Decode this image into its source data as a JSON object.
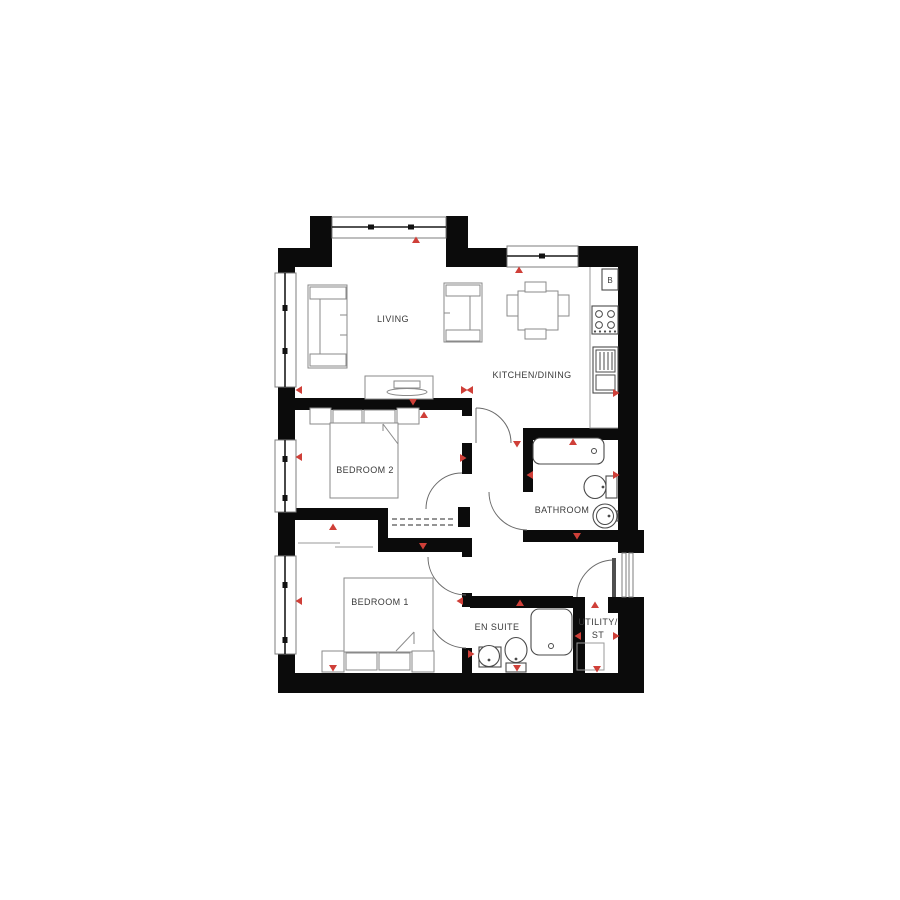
{
  "floorplan": {
    "type": "apartment-floor-plan",
    "rooms": [
      {
        "id": "living",
        "label": "LIVING"
      },
      {
        "id": "kitchen_dining",
        "label": "KITCHEN/DINING"
      },
      {
        "id": "bedroom2",
        "label": "BEDROOM 2"
      },
      {
        "id": "bedroom1",
        "label": "BEDROOM 1"
      },
      {
        "id": "bathroom",
        "label": "BATHROOM"
      },
      {
        "id": "ensuite",
        "label": "EN SUITE"
      },
      {
        "id": "utility",
        "label": "UTILITY/ ST"
      }
    ],
    "labels": {
      "living": "LIVING",
      "kitchen": "KITCHEN/DINING",
      "bedroom2": "BEDROOM 2",
      "bedroom1": "BEDROOM 1",
      "bathroom": "BATHROOM",
      "ensuite": "EN SUITE",
      "utility_line1": "UTILITY/",
      "utility_line2": "ST",
      "boiler": "B"
    },
    "fixtures": [
      "sofa-3-seat",
      "sofa-2-seat",
      "tv-unit",
      "dining-table-4-chairs",
      "boiler",
      "hob-4-ring",
      "kitchen-sink-drainer",
      "double-bed-bedroom2",
      "double-bed-bedroom1",
      "wardrobe-cupboard",
      "bath",
      "toilet",
      "wash-basin",
      "shower-tray",
      "ensuite-basin",
      "ensuite-toilet",
      "utility-storage-unit"
    ]
  },
  "colors": {
    "wall": "#0b0b0b",
    "marker_red": "#cf3f38",
    "furniture": "#8a8a8a",
    "fixture": "#4a4a4a",
    "window_frame": "#7d7d7d",
    "door_arc": "#6b6b6b",
    "label_text": "#3a3a3a",
    "floor": "#ffffff"
  }
}
